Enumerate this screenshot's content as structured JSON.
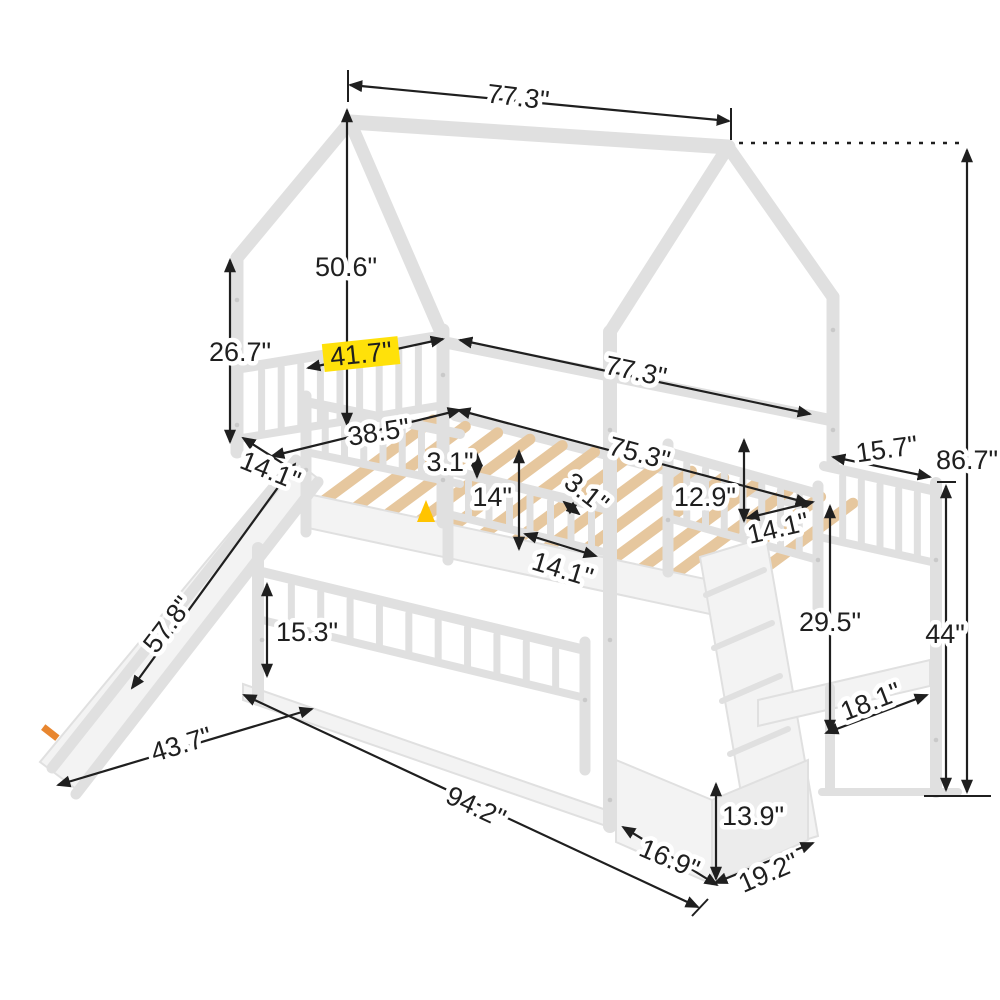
{
  "figure": {
    "type": "product-dimension-diagram",
    "subject": "white house-frame twin bunk bed with slide, storage staircase and drawer",
    "unit": "inches"
  },
  "colors": {
    "bg": "#ffffff",
    "dim": "#1f1f1f",
    "frame_fill": "#f3f3f3",
    "frame_edge": "#e0e0e0",
    "wood": "#e6c79e",
    "hl": "#ffe10a",
    "warn": "#ffc400",
    "sticker": "#e8862f"
  },
  "icons": {
    "warning_triangle": "warning-triangle",
    "slide_sticker": "orange-label"
  },
  "dims": [
    {
      "text": "77.3\""
    },
    {
      "text": "50.6\""
    },
    {
      "text": "26.7\""
    },
    {
      "text": "41.7\""
    },
    {
      "text": "77.3\""
    },
    {
      "text": "38.5\""
    },
    {
      "text": "14.1\""
    },
    {
      "text": "3.1\""
    },
    {
      "text": "14\""
    },
    {
      "text": "3.1\""
    },
    {
      "text": "75.3\""
    },
    {
      "text": "12.9\""
    },
    {
      "text": "14.1\""
    },
    {
      "text": "14.1\""
    },
    {
      "text": "15.7\""
    },
    {
      "text": "86.7\""
    },
    {
      "text": "44\""
    },
    {
      "text": "29.5\""
    },
    {
      "text": "18.1\""
    },
    {
      "text": "13.9\""
    },
    {
      "text": "16.9\""
    },
    {
      "text": "19.2\""
    },
    {
      "text": "57.8\""
    },
    {
      "text": "15.3\""
    },
    {
      "text": "43.7\""
    },
    {
      "text": "94.2\""
    }
  ]
}
